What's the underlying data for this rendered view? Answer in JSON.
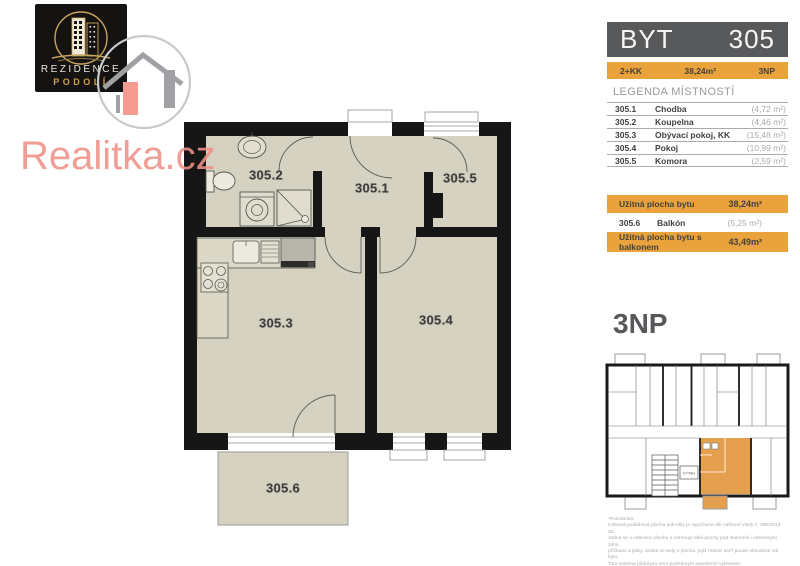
{
  "branding": {
    "logo_line1": "REZIDENCE",
    "logo_line2": "PODOLÍ",
    "watermark": "Realitka.cz"
  },
  "header": {
    "title_left": "BYT",
    "title_right": "305",
    "layout": "2+KK",
    "area": "38,24m²",
    "floor": "3NP"
  },
  "legend": {
    "title": "LEGENDA MÍSTNOSTÍ",
    "rows": [
      {
        "number": "305.1",
        "name": "Chodba",
        "area": "(4,72 m²)"
      },
      {
        "number": "305.2",
        "name": "Koupelna",
        "area": "(4,46 m²)"
      },
      {
        "number": "305.3",
        "name": "Obývací pokoj, KK",
        "area": "(15,48 m²)"
      },
      {
        "number": "305.4",
        "name": "Pokoj",
        "area": "(10,99 m²)"
      },
      {
        "number": "305.5",
        "name": "Komora",
        "area": "(2,59 m²)"
      }
    ]
  },
  "summary": {
    "usable_label": "Užitná plocha bytu",
    "usable_value": "38,24m²",
    "balcony_number": "305.6",
    "balcony_name": "Balkón",
    "balcony_area": "(5,25 m²)",
    "total_label": "Užitná plocha bytu s balkonem",
    "total_value": "43,49m²"
  },
  "floor_section": {
    "title": "3NP",
    "elevator_label": "VÝTAH"
  },
  "plan": {
    "labels": [
      "305.2",
      "305.1",
      "305.5",
      "305.3",
      "305.4",
      "305.6"
    ]
  },
  "disclaimer": {
    "lines": [
      "*Poznámka:",
      "Celková podlahová plocha jednotky je vypočtena dle nařízení vlády č. 366/2013 Sb.",
      "Jedná se o celkovou plochu a zahrnuje také plochy pod okenními i nenosnými zdmi,",
      "příčkami a jádry. Jedná se tedy o plochu, jejíž hranici tvoří pouze obvodové zdi bytu.",
      "Toto schéma půdorysu není podrobným stavebním výkresem.",
      "Developer si vyhrazuje právo na změnu, plochy jednotlivých místností jsou pouze orientační.",
      "Vybavení a zařízení v půdorysu není součástí dodávky."
    ]
  },
  "colors": {
    "accent_orange": "#E9A23C",
    "plan_highlight_orange": "#E5A04F",
    "header_gray": "#58595B",
    "floor_beige": "#D6D2C1",
    "wall_black": "#161616",
    "watermark_red": "#EF9087",
    "legend_text_dark": "#414042",
    "legend_text_light": "#A9ABAE"
  }
}
